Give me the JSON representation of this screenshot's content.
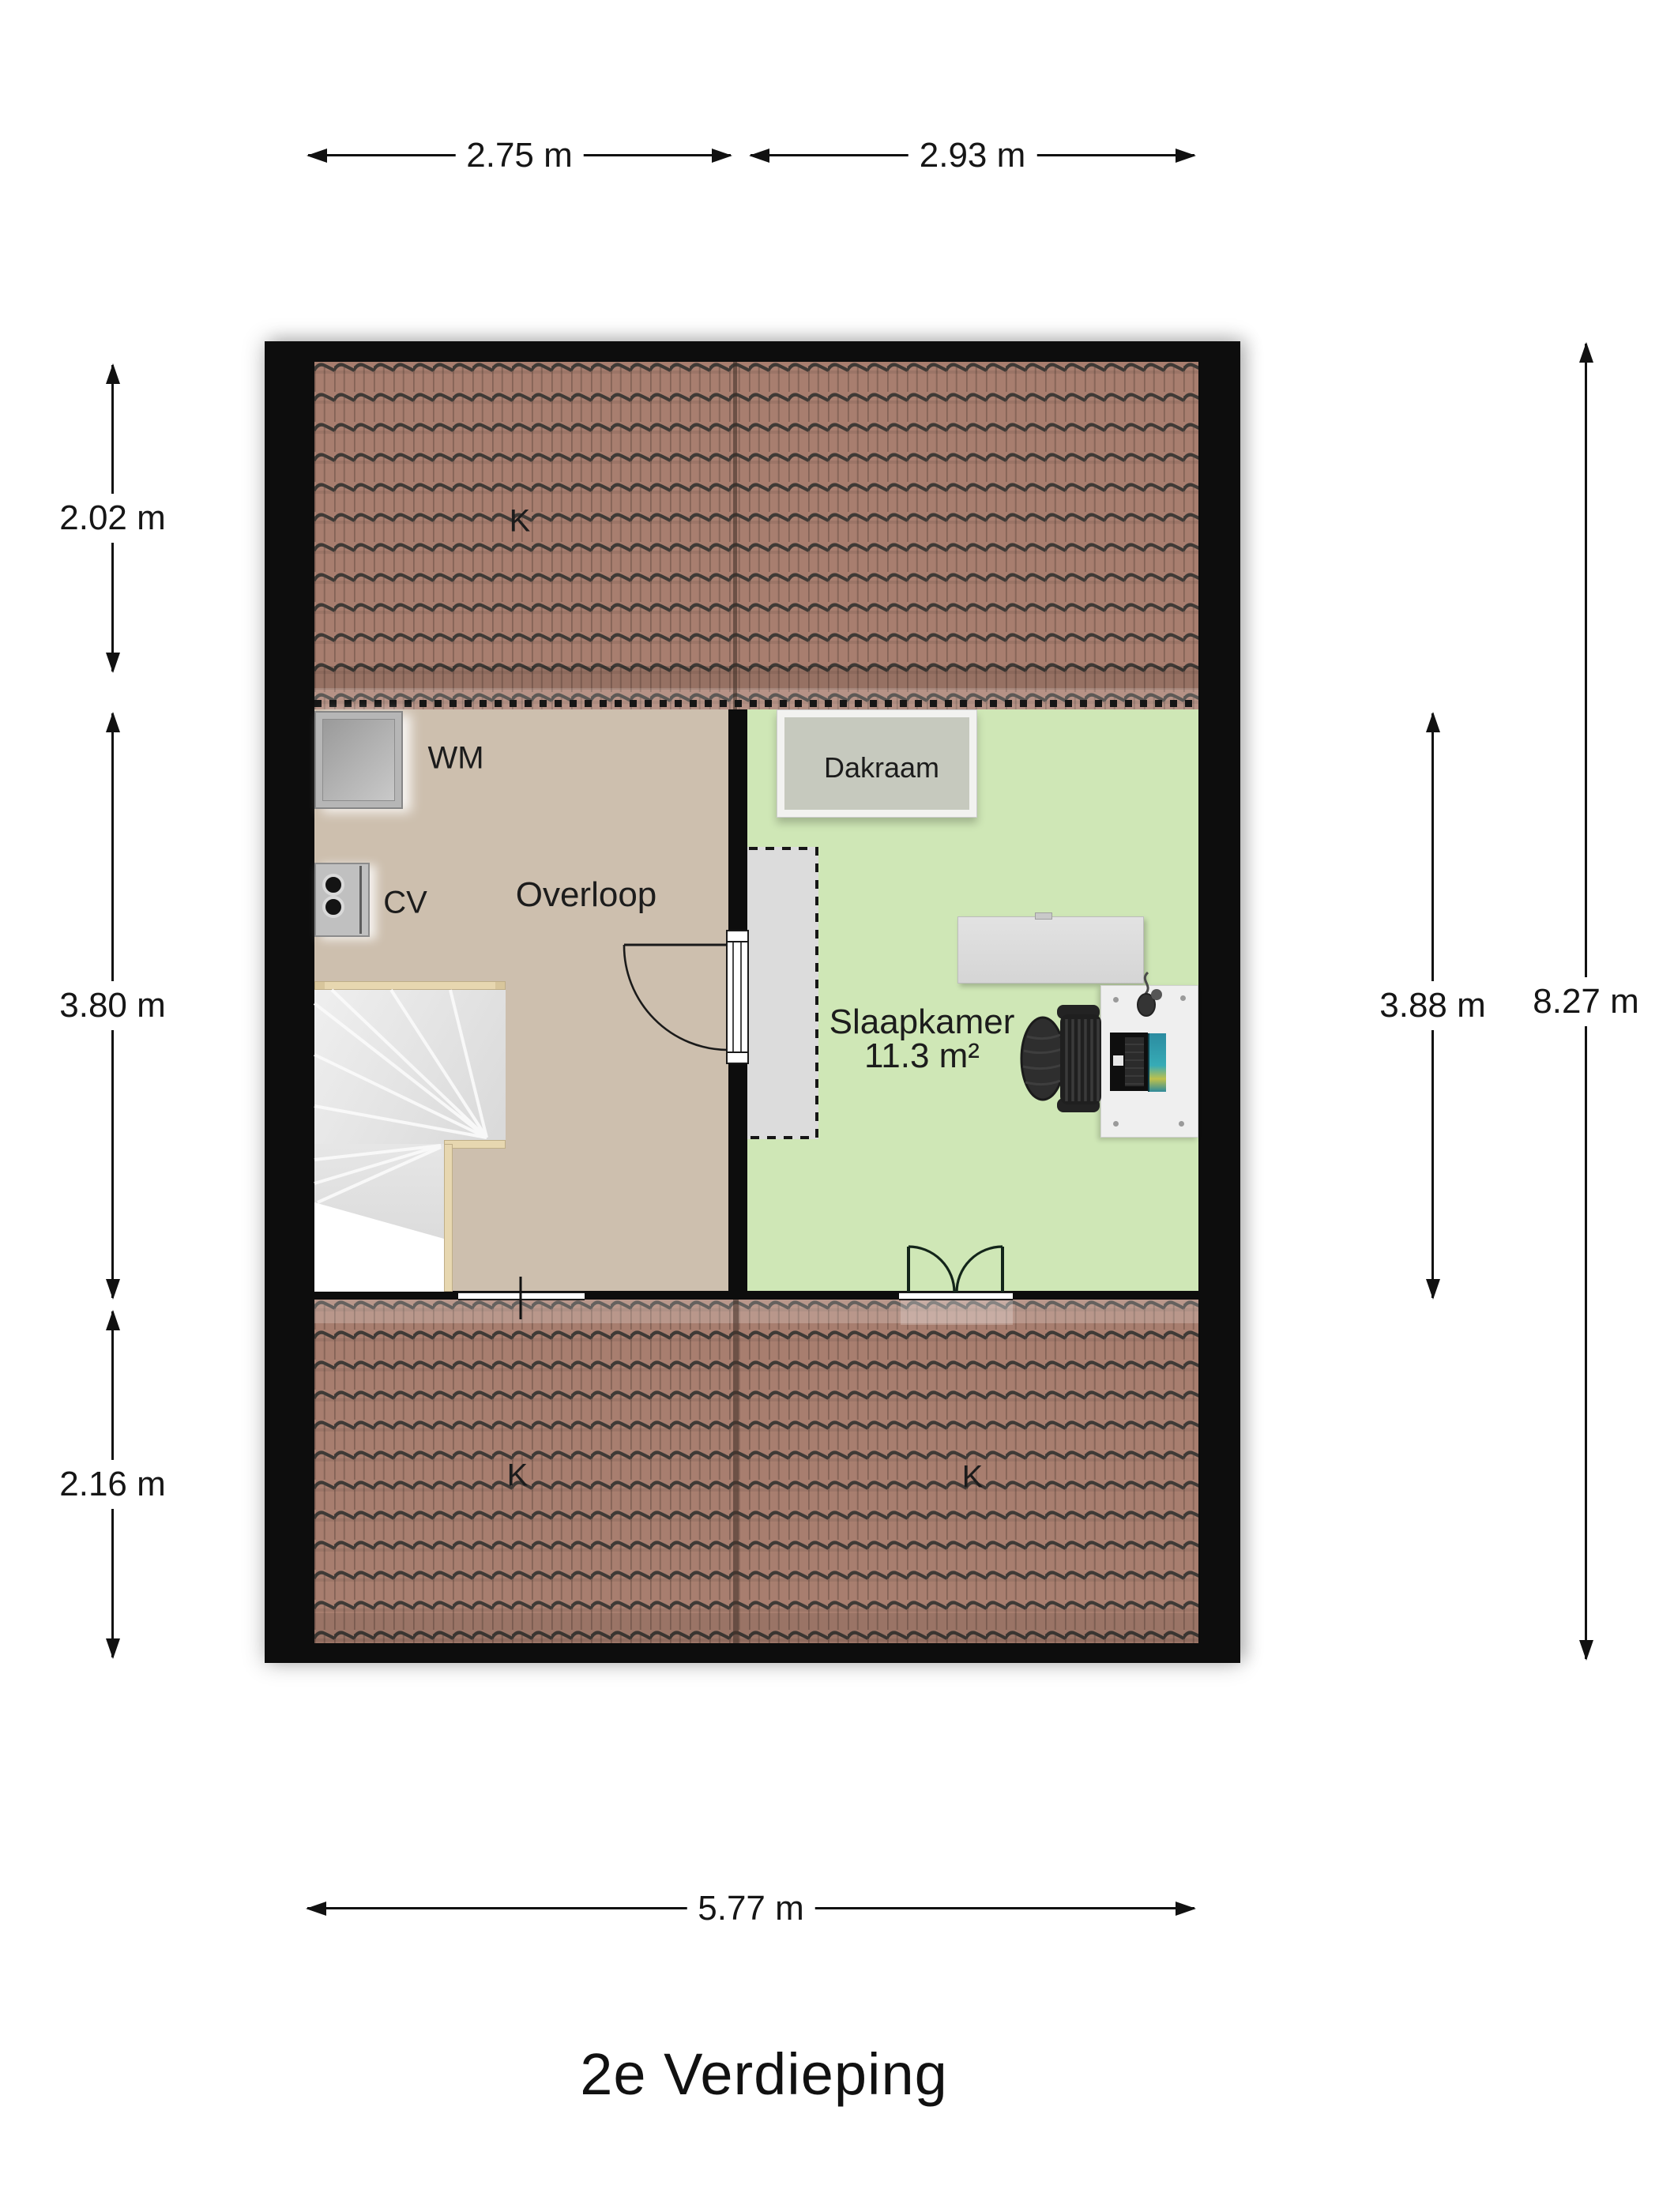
{
  "title": "2e Verdieping",
  "dimensions": {
    "top": [
      {
        "label": "2.75 m"
      },
      {
        "label": "2.93 m"
      }
    ],
    "left": [
      {
        "label": "2.02 m"
      },
      {
        "label": "3.80 m"
      },
      {
        "label": "2.16 m"
      }
    ],
    "right": [
      {
        "label": "3.88 m"
      },
      {
        "label": "8.27 m"
      }
    ],
    "bottom": [
      {
        "label": "5.77 m"
      }
    ]
  },
  "rooms": {
    "overloop": {
      "label": "Overloop"
    },
    "slaapkamer": {
      "label": "Slaapkamer",
      "area": "11.3 m²"
    }
  },
  "features": {
    "dakraam": {
      "label": "Dakraam"
    },
    "washing_machine": {
      "label": "WM"
    },
    "boiler": {
      "label": "CV"
    },
    "roof_sections": [
      {
        "label": "K"
      },
      {
        "label": "K"
      },
      {
        "label": "K"
      }
    ]
  },
  "colors": {
    "wall": "#0d0d0d",
    "roof_tile": "#a87e6f",
    "roof_line": "#3f3a36",
    "overloop_floor": "#cdbfae",
    "bedroom_floor": "#cfe7b6",
    "dashed_zone": "#dcdcdc",
    "stairs": "#e3e3e3",
    "wood_trim": "#e7d7b0"
  }
}
